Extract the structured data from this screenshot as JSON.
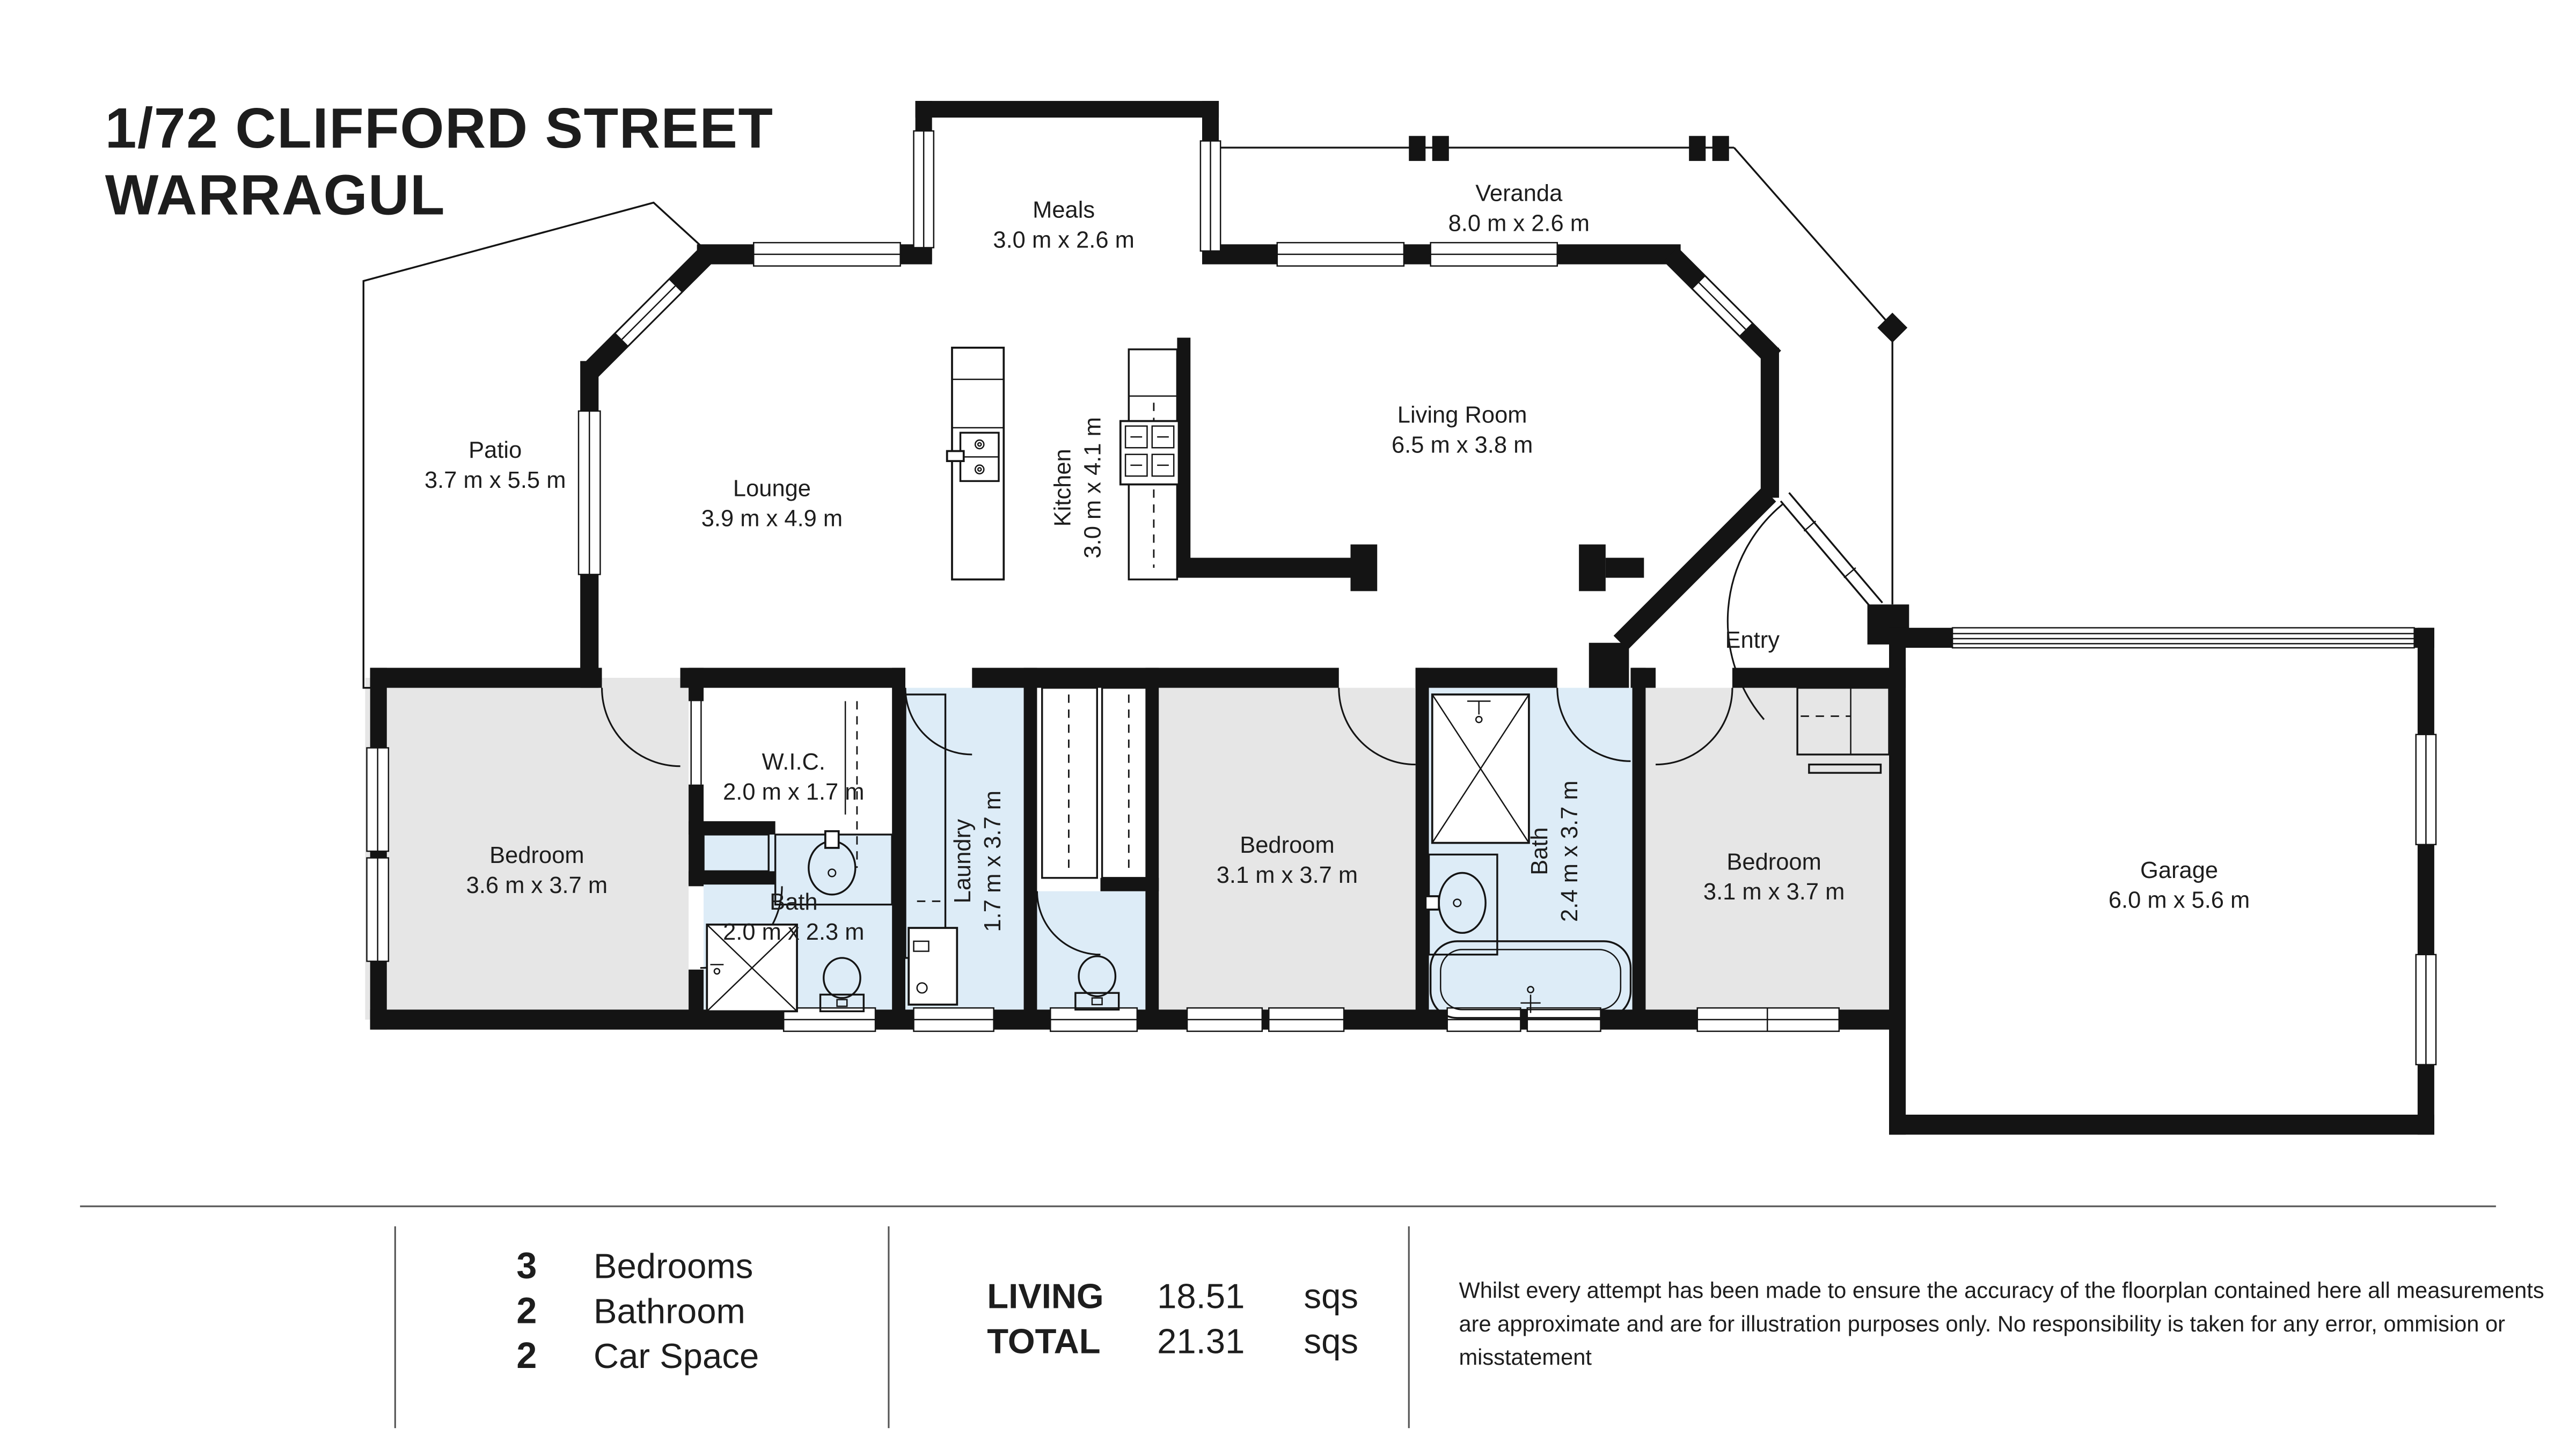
{
  "title": {
    "line1": "1/72 CLIFFORD STREET",
    "line2": "WARRAGUL"
  },
  "rooms": {
    "meals": {
      "name": "Meals",
      "dims": "3.0 m x 2.6 m"
    },
    "veranda": {
      "name": "Veranda",
      "dims": "8.0 m x 2.6 m"
    },
    "patio": {
      "name": "Patio",
      "dims": "3.7 m x 5.5 m"
    },
    "lounge": {
      "name": "Lounge",
      "dims": "3.9 m x 4.9 m"
    },
    "kitchen": {
      "name": "Kitchen",
      "dims": "3.0 m x 4.1 m"
    },
    "living": {
      "name": "Living Room",
      "dims": "6.5 m x 3.8 m"
    },
    "entry": {
      "name": "Entry"
    },
    "bedroom1": {
      "name": "Bedroom",
      "dims": "3.6 m x 3.7 m"
    },
    "wic": {
      "name": "W.I.C.",
      "dims": "2.0 m x 1.7 m"
    },
    "bath1": {
      "name": "Bath",
      "dims": "2.0 m x 2.3 m"
    },
    "laundry": {
      "name": "Laundry",
      "dims": "1.7 m x 3.7 m"
    },
    "bedroom2": {
      "name": "Bedroom",
      "dims": "3.1 m x 3.7 m"
    },
    "bath2": {
      "name": "Bath",
      "dims": "2.4 m x 3.7 m"
    },
    "bedroom3": {
      "name": "Bedroom",
      "dims": "3.1 m x 3.7 m"
    },
    "garage": {
      "name": "Garage",
      "dims": "6.0 m x 5.6 m"
    }
  },
  "summary": {
    "stats": [
      {
        "count": "3",
        "label": "Bedrooms"
      },
      {
        "count": "2",
        "label": "Bathroom"
      },
      {
        "count": "2",
        "label": "Car Space"
      }
    ],
    "areas": [
      {
        "label": "LIVING",
        "value": "18.51",
        "unit": "sqs"
      },
      {
        "label": "TOTAL",
        "value": "21.31",
        "unit": "sqs"
      }
    ],
    "disclaimer_lines": [
      "Whilst every attempt has been made to ensure the accuracy of the floorplan contained here all measurements",
      "are approximate and are for illustration purposes only. No responsibility is taken for any error, ommision or",
      "misstatement"
    ]
  },
  "colors": {
    "wall": "#141414",
    "bedroom_fill": "#e6e6e6",
    "wet_area_fill": "#ddecf7",
    "background": "#ffffff",
    "text": "#1d1d1d"
  }
}
